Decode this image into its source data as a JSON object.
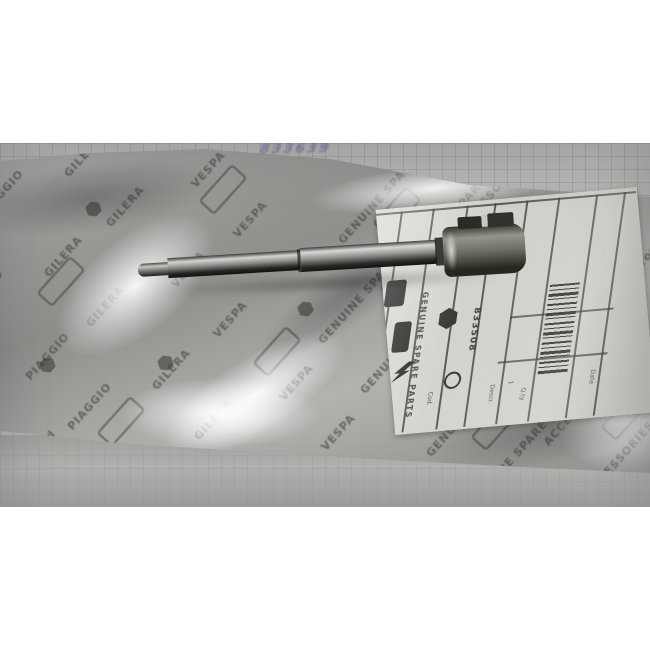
{
  "meta": {
    "description": "Photograph of a genuine Piaggio spare part: a polished steel gear shaft with a forked clevis end, sealed in a clear printed plastic bag with a parts label, lying on squared grid paper"
  },
  "photo": {
    "handwriting": {
      "text": "833639",
      "ink_color": "#5f5f9b"
    },
    "bag": {
      "pattern_words": [
        "PIAGGIO",
        "GILERA",
        "VESPA",
        "GENUINE SPARE PARTS",
        "ACCESSORIES",
        "approved"
      ],
      "base_color": "#9a9a97"
    },
    "label": {
      "vertical_text": "GENUINE SPARE PARTS",
      "part_number": "833508",
      "qty": "1",
      "fields": [
        "Cod.",
        "Descr.",
        "Q.ty",
        "Date"
      ],
      "logos": [
        "vespa-box",
        "gilera-box",
        "aprilia-arrow",
        "piaggio-hexagon",
        "approved-roundel"
      ],
      "barcode": "present",
      "paper_color": "#d6d4ce"
    },
    "part": {
      "type": "steel shaft with clevis fork head",
      "finish_color": "#2a2a28"
    },
    "background": {
      "paper_color": "#b6b6b3",
      "grid": "squared"
    }
  }
}
